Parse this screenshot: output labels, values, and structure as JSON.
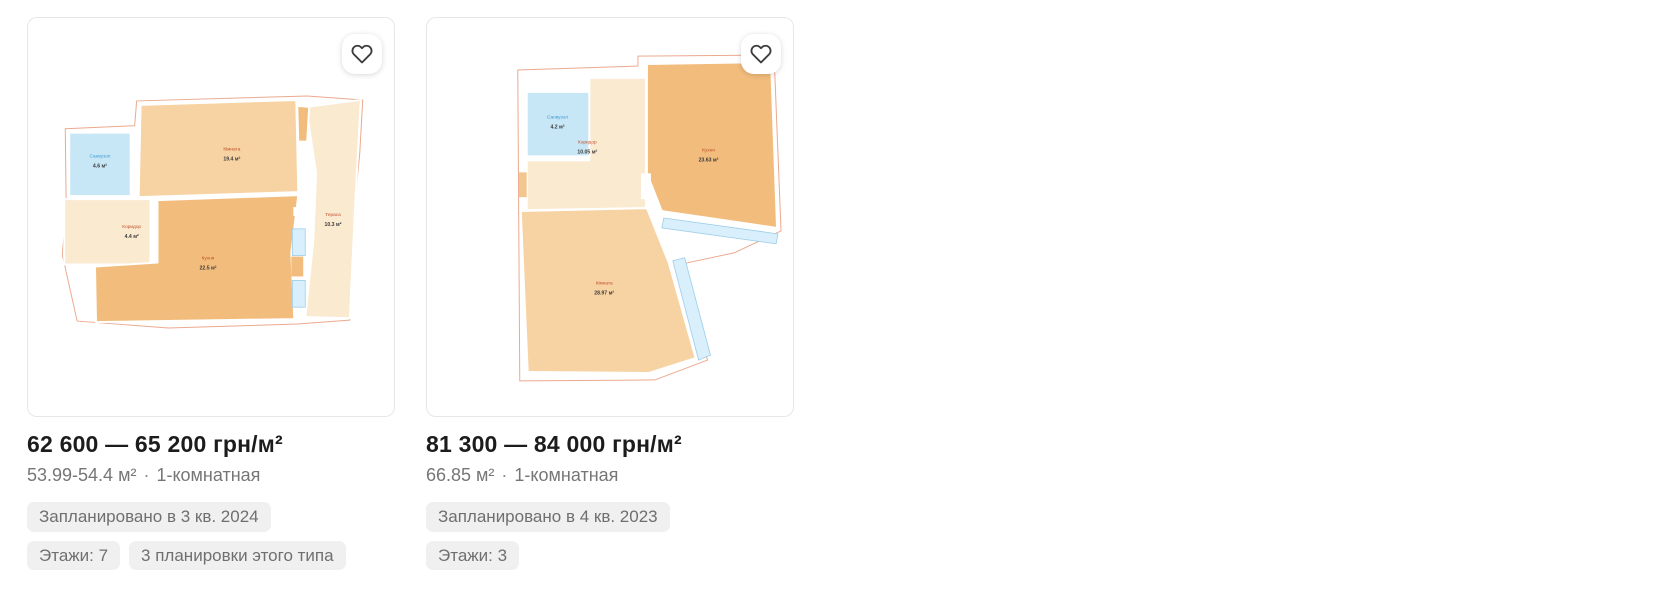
{
  "colors": {
    "room_orange": "#f2bc7c",
    "room_light_orange": "#f7d2a2",
    "hall_cream": "#faead0",
    "bathroom_blue": "#c7e6f6",
    "glazing_blue": "#d9effb",
    "plan_outline": "#eba98f",
    "room_label_warm": "#c2512c",
    "room_label_blue": "#3d9bd4",
    "badge_bg": "#f0f0f0",
    "badge_text": "#6f6f6f",
    "subtitle_text": "#767676",
    "price_text": "#1c1c1c"
  },
  "cards": [
    {
      "favorite_icon": "heart-outline",
      "price": "62 600 — 65 200 грн/м²",
      "area_range": "53.99-54.4 м²",
      "dot": "·",
      "room_type": "1-комнатная",
      "badges": [
        "Запланировано в 3 кв. 2024",
        "Этажи: 7",
        "3 планировки этого типа"
      ],
      "plan_rooms": [
        {
          "name": "Санвузол",
          "area": "4.6 м²"
        },
        {
          "name": "Кімната",
          "area": "19.4 м²"
        },
        {
          "name": "Коридор",
          "area": "4.4 м²"
        },
        {
          "name": "Кухня",
          "area": "22.5 м²"
        },
        {
          "name": "Тераса",
          "area": "10.3 м²"
        }
      ]
    },
    {
      "favorite_icon": "heart-outline",
      "price": "81 300 — 84 000 грн/м²",
      "area_range": "66.85 м²",
      "dot": "·",
      "room_type": "1-комнатная",
      "badges": [
        "Запланировано в 4 кв. 2023",
        "Этажи: 3"
      ],
      "plan_rooms": [
        {
          "name": "Санвузол",
          "area": "4.2 м²"
        },
        {
          "name": "Коридор",
          "area": "10.05 м²"
        },
        {
          "name": "Кухня",
          "area": "23.63 м²"
        },
        {
          "name": "Кімната",
          "area": "28.97 м²"
        }
      ]
    }
  ]
}
